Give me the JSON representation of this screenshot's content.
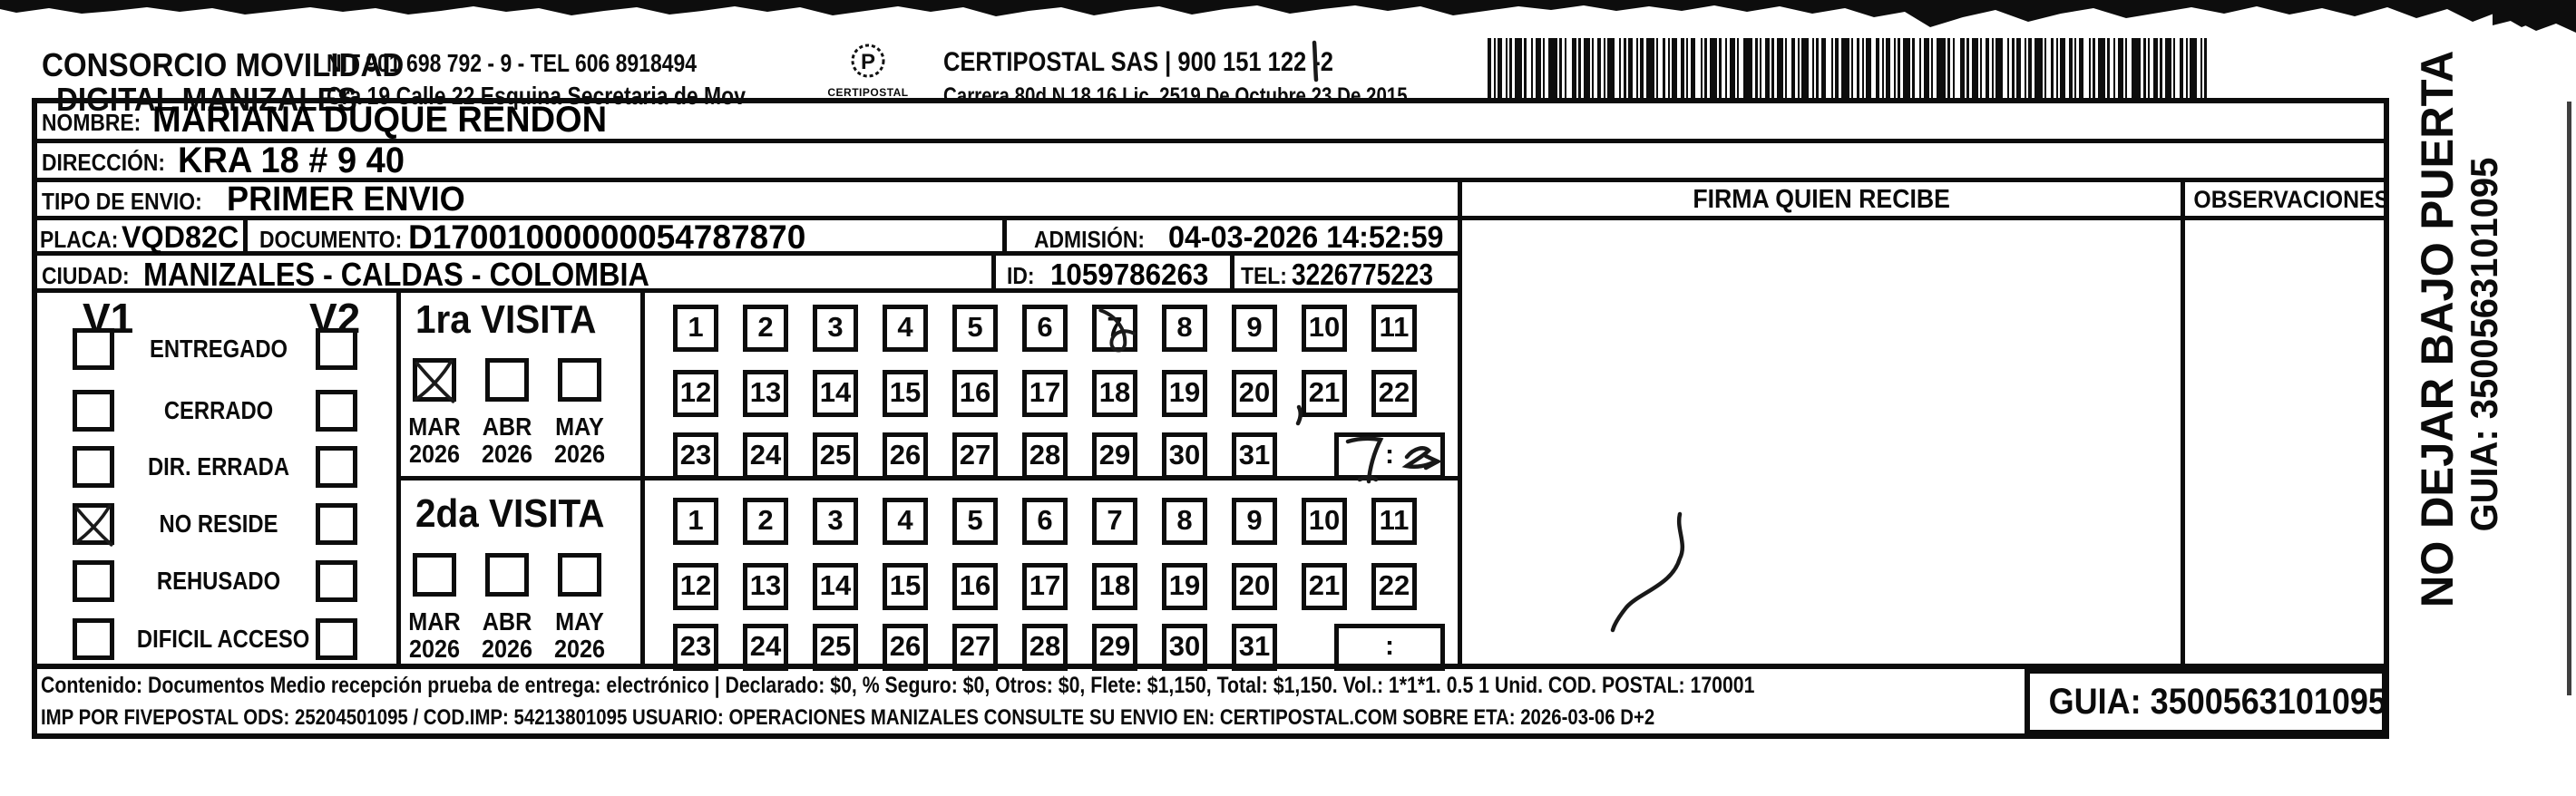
{
  "header": {
    "company_line1": "CONSORCIO MOVILIDAD",
    "company_line2": "DIGITAL MANIZALES",
    "nit_line": "NIT 901 698 792 - 9 - TEL 606 8918494",
    "address_line": "Cra 19 Calle 22 Esquina Secretaria de Mov",
    "logo_text": "CERTIPOSTAL",
    "carrier_line1": "CERTIPOSTAL SAS | 900 151 122 -2",
    "carrier_line2": "Carrera 80d N 18 16  Lic. 2519 De Octubre 23 De 2015"
  },
  "shipment": {
    "nombre_label": "NOMBRE:",
    "nombre_value": "MARIANA DUQUE RENDON",
    "direccion_label": "DIRECCIÓN:",
    "direccion_value": "KRA 18 # 9 40",
    "tipo_envio_label": "TIPO DE ENVIO:",
    "tipo_envio_value": "PRIMER ENVIO",
    "placa_label": "PLACA:",
    "placa_value": "VQD82C",
    "documento_label": "DOCUMENTO:",
    "documento_value": "D17001000000054787870",
    "admision_label": "ADMISIÓN:",
    "admision_value": "04-03-2026 14:52:59",
    "ciudad_label": "CIUDAD:",
    "ciudad_value": "MANIZALES - CALDAS - COLOMBIA",
    "id_label": "ID:",
    "id_value": "1059786263",
    "tel_label": "TEL:",
    "tel_value": "3226775223"
  },
  "status_panel": {
    "v1_header": "V1",
    "v2_header": "V2",
    "options": [
      {
        "label": "ENTREGADO",
        "v1_checked": false,
        "v2_checked": false
      },
      {
        "label": "CERRADO",
        "v1_checked": false,
        "v2_checked": false
      },
      {
        "label": "DIR. ERRADA",
        "v1_checked": false,
        "v2_checked": false
      },
      {
        "label": "NO RESIDE",
        "v1_checked": true,
        "v2_checked": false
      },
      {
        "label": "REHUSADO",
        "v1_checked": false,
        "v2_checked": false
      },
      {
        "label": "DIFICIL ACCESO",
        "v1_checked": false,
        "v2_checked": false
      }
    ]
  },
  "day_rows": [
    [
      1,
      2,
      3,
      4,
      5,
      6,
      7,
      8,
      9,
      10,
      11
    ],
    [
      12,
      13,
      14,
      15,
      16,
      17,
      18,
      19,
      20,
      21,
      22
    ],
    [
      23,
      24,
      25,
      26,
      27,
      28,
      29,
      30,
      31
    ]
  ],
  "visits": [
    {
      "title": "1ra VISITA",
      "months": [
        {
          "month": "MAR",
          "year": "2026",
          "checked": true
        },
        {
          "month": "ABR",
          "year": "2026",
          "checked": false
        },
        {
          "month": "MAY",
          "year": "2026",
          "checked": false
        }
      ],
      "marked_day": 7,
      "time_separator": ":",
      "time_handwritten": true
    },
    {
      "title": "2da VISITA",
      "months": [
        {
          "month": "MAR",
          "year": "2026",
          "checked": false
        },
        {
          "month": "ABR",
          "year": "2026",
          "checked": false
        },
        {
          "month": "MAY",
          "year": "2026",
          "checked": false
        }
      ],
      "marked_day": null,
      "time_separator": ":",
      "time_handwritten": false
    }
  ],
  "delivery": {
    "firma_header": "FIRMA QUIEN RECIBE",
    "observaciones_header": "OBSERVACIONES"
  },
  "side_note": {
    "line1": "NO DEJAR BAJO PUERTA",
    "line2": "GUIA: 3500563101095"
  },
  "footer": {
    "content_line": "Contenido: Documentos Medio recepción prueba de entrega: electrónico | Declarado: $0, % Seguro: $0, Otros: $0, Flete: $1,150, Total: $1,150. Vol.: 1*1*1. 0.5  1 Unid. COD. POSTAL: 170001",
    "imp_line": "IMP POR FIVEPOSTAL ODS: 25204501095 / COD.IMP: 54213801095 USUARIO: OPERACIONES MANIZALES CONSULTE SU ENVIO EN: CERTIPOSTAL.COM SOBRE ETA: 2026-03-06 D+2",
    "guia_box": "GUIA: 3500563101095"
  },
  "ink_color": "#0c0c0c"
}
